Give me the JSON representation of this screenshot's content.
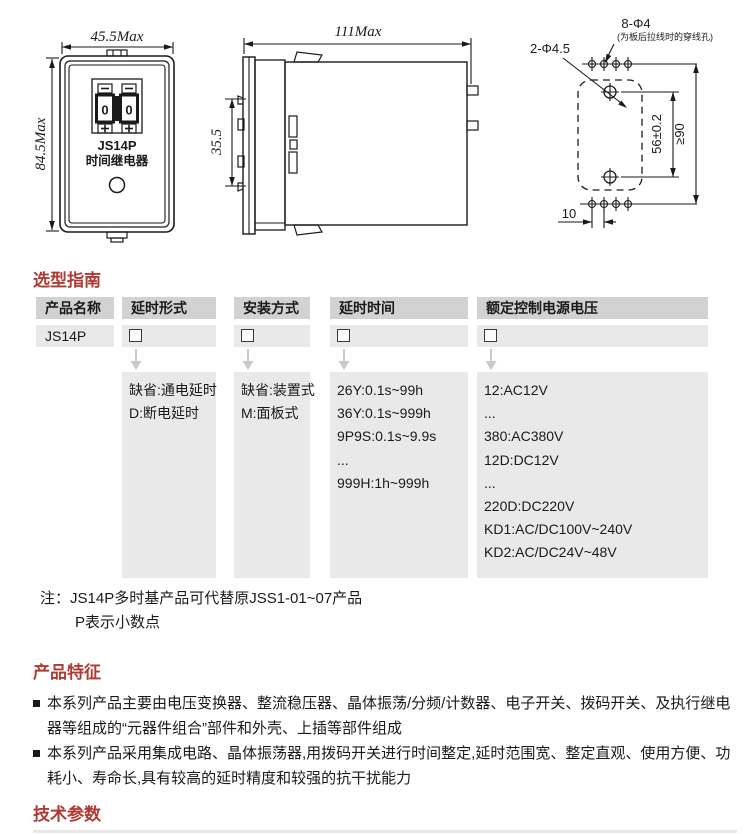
{
  "drawings": {
    "front_view": {
      "width_dim": "45.5Max",
      "height_dim": "84.5Max",
      "digit_left": "0",
      "digit_right": "0",
      "model": "JS14P",
      "device_label": "时间继电器"
    },
    "side_view": {
      "width_dim": "111Max",
      "height_dim": "35.5"
    },
    "panel_view": {
      "wire_holes_dim": "8-Φ4",
      "wire_holes_note": "(为板后拉线时的穿线孔)",
      "mount_holes_dim": "2-Φ4.5",
      "hole_spacing_dim": "56±0.2",
      "clearance_dim": "≥90",
      "pitch_dim": "10"
    }
  },
  "selection_guide": {
    "title": "选型指南",
    "columns": [
      {
        "header": "产品名称",
        "value": "JS14P",
        "options": []
      },
      {
        "header": "延时形式",
        "options": [
          "缺省:通电延时",
          "D:断电延时"
        ]
      },
      {
        "header": "安装方式",
        "options": [
          "缺省:装置式",
          "M:面板式"
        ]
      },
      {
        "header": "延时时间",
        "options": [
          "26Y:0.1s~99h",
          "36Y:0.1s~999h",
          "9P9S:0.1s~9.9s",
          "...",
          "999H:1h~999h"
        ]
      },
      {
        "header": "额定控制电源电压",
        "options": [
          "12:AC12V",
          "...",
          "380:AC380V",
          "12D:DC12V",
          "...",
          "220D:DC220V",
          "KD1:AC/DC100V~240V",
          "KD2:AC/DC24V~48V"
        ]
      }
    ],
    "notes": [
      "注：JS14P多时基产品可代替原JSS1-01~07产品",
      "P表示小数点"
    ]
  },
  "features": {
    "title": "产品特征",
    "bullets": [
      "本系列产品主要由电压变换器、整流稳压器、晶体振荡/分频/计数器、电子开关、拨码开关、及执行继电器等组成的“元器件组合”部件和外壳、上插等部件组成",
      "本系列产品采用集成电路、晶体振荡器,用拨码开关进行时间整定,延时范围宽、整定直观、使用方便、功耗小、寿命长,具有较高的延时精度和较强的抗干扰能力"
    ]
  },
  "tech_params": {
    "title": "技术参数"
  },
  "colors": {
    "heading_red": "#b03a33",
    "header_gray": "#d2d2d2",
    "cell_gray": "#e9e9e9",
    "line_black": "#1a1a1a",
    "arrow_gray": "#c9c9c9"
  }
}
